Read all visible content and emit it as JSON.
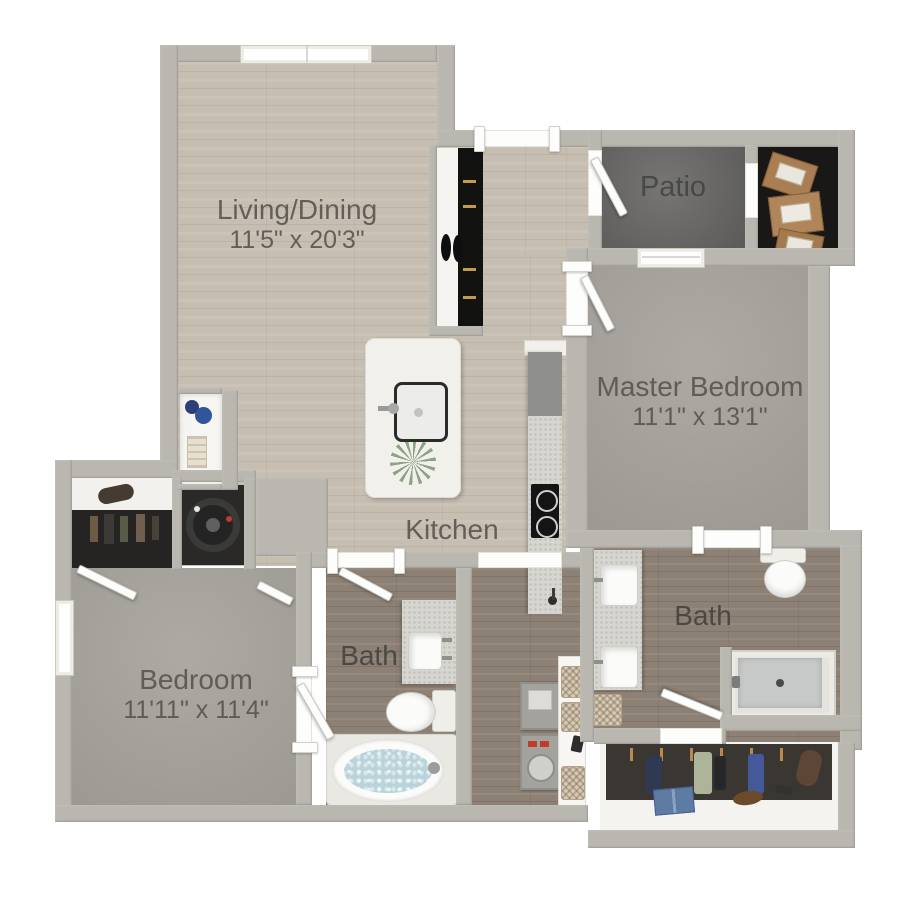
{
  "plan": {
    "rooms": {
      "living_dining": {
        "label": "Living/Dining",
        "dimensions": "11'5\" x 20'3\""
      },
      "patio": {
        "label": "Patio"
      },
      "master_bedroom": {
        "label": "Master Bedroom",
        "dimensions": "11'1\" x 13'1\""
      },
      "kitchen": {
        "label": "Kitchen"
      },
      "bath": {
        "label": "Bath"
      },
      "master_bath": {
        "label": "Bath"
      },
      "bedroom": {
        "label": "Bedroom",
        "dimensions": "11'11\" x 11'4\""
      }
    },
    "fixtures": {
      "kitchen": [
        "kitchen-island",
        "island-sink",
        "potted-plant",
        "refrigerator",
        "cooktop",
        "counter-sink"
      ],
      "bath": [
        "vanity-sink",
        "toilet",
        "bathtub",
        "double-vanity",
        "shower",
        "hamper",
        "linen-baskets"
      ],
      "laundry": [
        "washer-dryer"
      ],
      "closets": [
        "coat-closet-shoes",
        "hanging-clothes",
        "storage-boxes",
        "walk-in-closet-clothes",
        "shelf-vases",
        "folded-towels"
      ]
    }
  },
  "colors": {
    "background": "#ffffff",
    "wall": "#b9b7af",
    "wood_light": "#c7beb2",
    "wood_dark": "#8d8175",
    "carpet": "#a8a49e",
    "patio_concrete": "#6c6b69",
    "closet_dark": "#191817",
    "counter_white": "#f1f0ea",
    "counter_speckle": "#d6d5cf",
    "appliance_black": "#141414",
    "fixture_white": "#fbfbf9",
    "tub_water": "#b9d3da",
    "plant_green": "#57a63e",
    "label_text": "#56524c",
    "accent_red": "#c03b2d",
    "basket_tan": "#d7cbb8",
    "box_cardboard": "#a97e52",
    "denim_blue": "#5d7ba3"
  }
}
